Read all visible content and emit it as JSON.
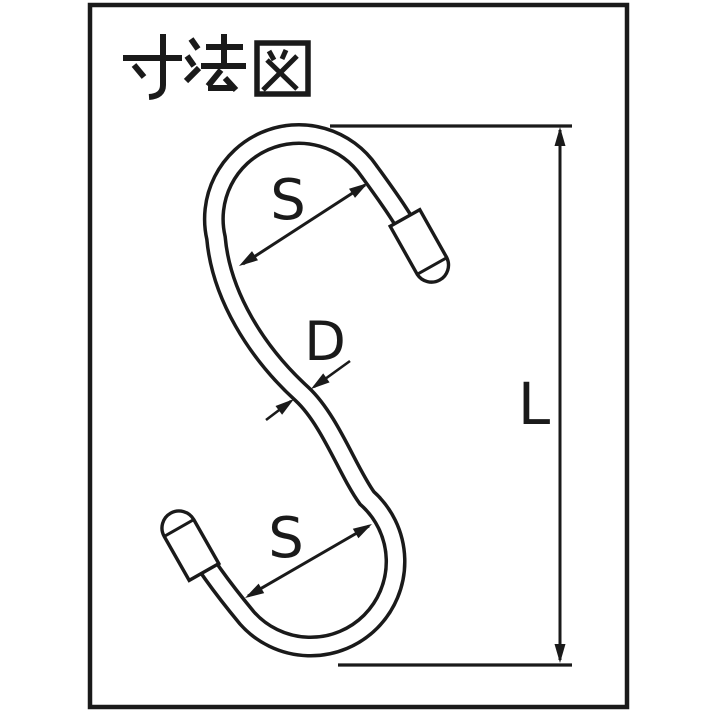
{
  "title": "寸法図",
  "colors": {
    "ink": "#1a1a1a",
    "paper": "#ffffff"
  },
  "diagram": {
    "type": "dimension-drawing",
    "subject": "S-hook with capped tips",
    "labels": {
      "top_opening": "S",
      "wire_diameter": "D",
      "bottom_opening": "S",
      "overall_length": "L"
    }
  }
}
